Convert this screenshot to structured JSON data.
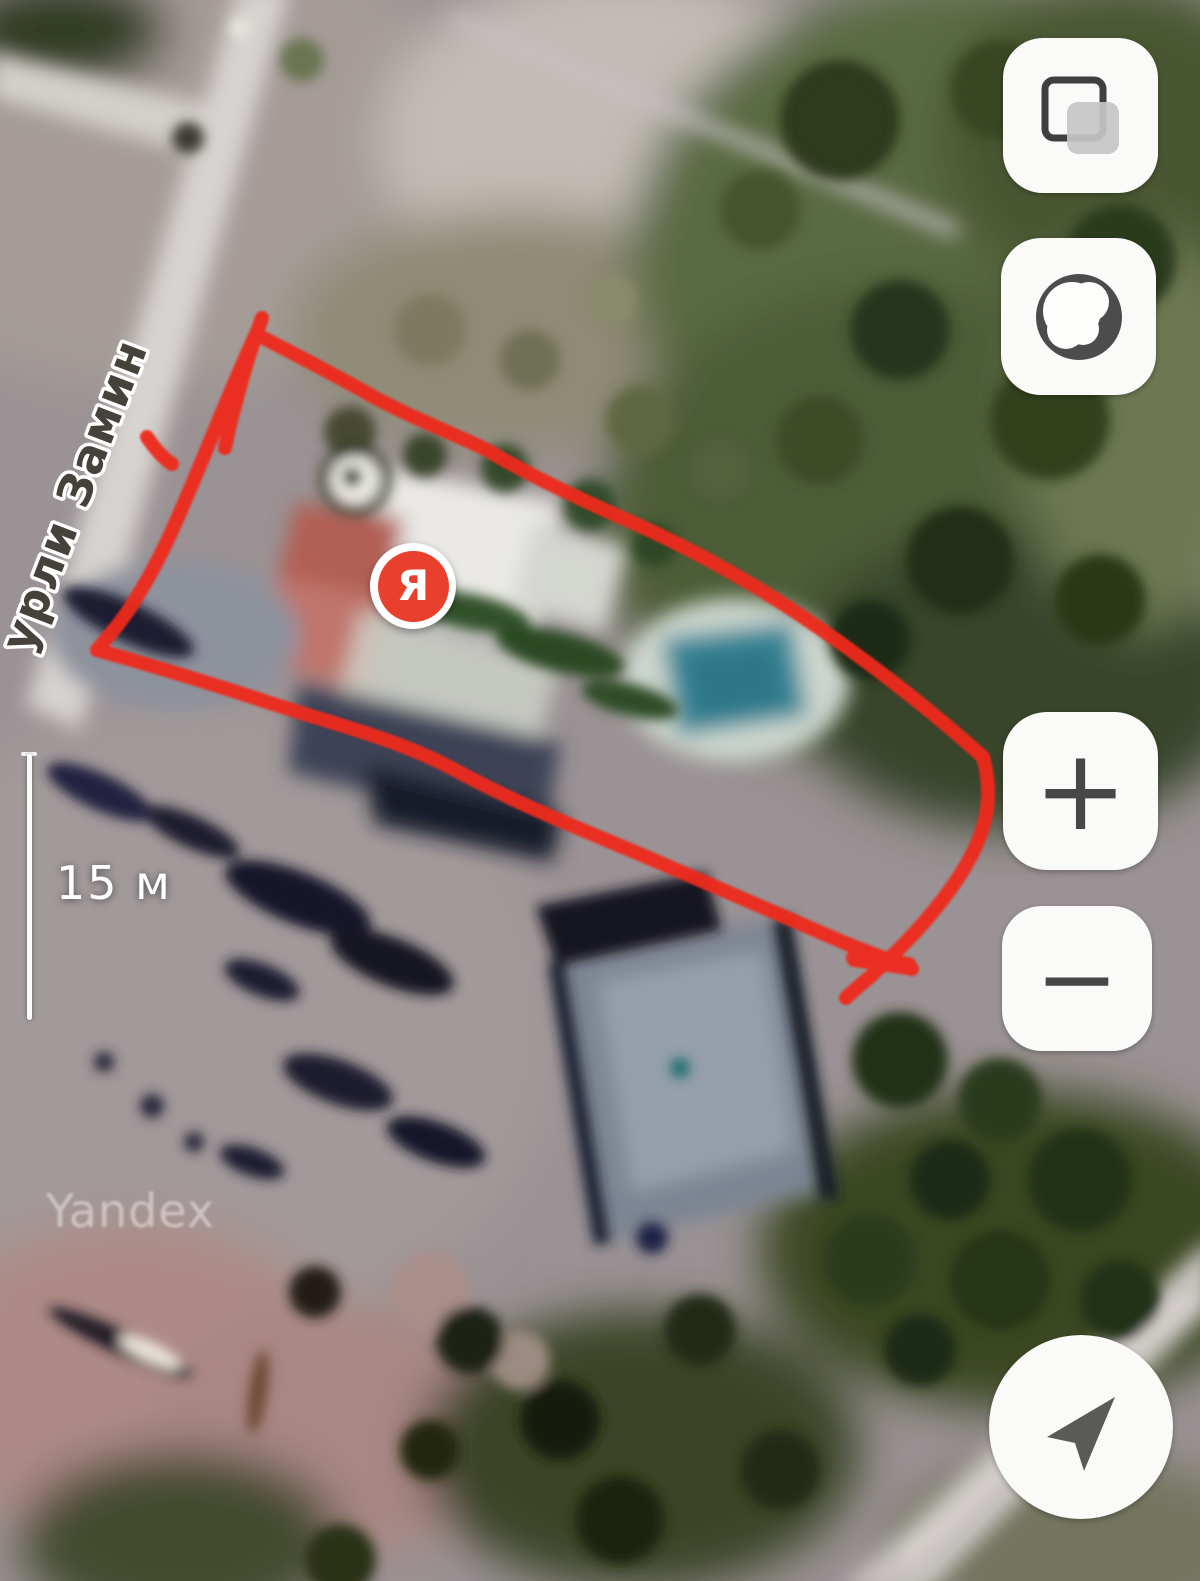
{
  "app": {
    "name": "yandex-maps",
    "view": "satellite"
  },
  "map": {
    "street_label": "урли Замин",
    "watermark": "Yandex",
    "scale_bar": {
      "label": "15 м"
    },
    "pin": {
      "label": "Я",
      "color": "#e8402c"
    },
    "annotation": {
      "shape": "hand-drawn plot outline",
      "color": "#ef2b1d"
    }
  },
  "controls": {
    "layers_button": {
      "icon": "layers-icon"
    },
    "map_type_button": {
      "icon": "globe-icon"
    },
    "zoom_in": {
      "label": "+"
    },
    "zoom_out": {
      "label": "−"
    },
    "locate_button": {
      "icon": "navigation-arrow-icon"
    }
  },
  "colors": {
    "button_bg": "#fafaf8",
    "button_icon": "#474747",
    "annotation_red": "#ef2b1d",
    "pin_red": "#e8402c"
  }
}
